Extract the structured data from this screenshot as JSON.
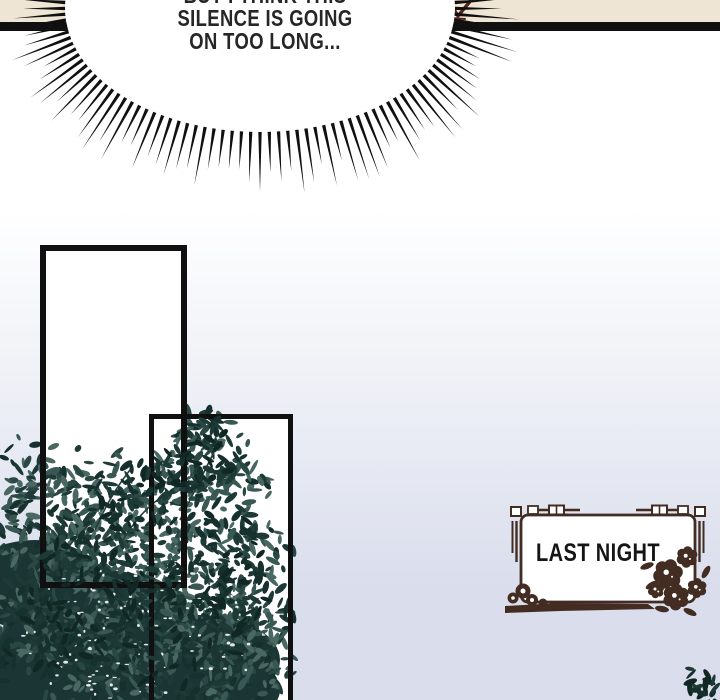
{
  "page": {
    "type": "webtoon-comic-panel"
  },
  "speech_bubble": {
    "style": "burst-shout-bubble",
    "lines": [
      "BUT I THINK THIS",
      "SILENCE IS GOING",
      "ON TOO LONG..."
    ]
  },
  "caption_box": {
    "label": "LAST NIGHT"
  },
  "icons": {
    "bubble": "burst-speech-bubble",
    "corner_ornament": "corner-bracket-ornament-icon",
    "scroll_ornament": "cloud-scroll-ornament-icon",
    "flower_ornament": "peony-flower-ornament-icon",
    "fragment": "torn-art-fragment-icon"
  },
  "colors": {
    "paper_beige": "#eee5d4",
    "ink": "#101010",
    "bubble_text": "#262626",
    "background_top": "#ffffff",
    "background_mid": "#e9ecf4",
    "background_bottom": "#d9ddec",
    "foliage_dark": "#16302d",
    "foliage_mid": "#2a4843",
    "foliage_light": "#4a6862",
    "ornament_brown": "#432d23",
    "fragment_maroon": "#52261d",
    "caption_text": "#151515"
  }
}
